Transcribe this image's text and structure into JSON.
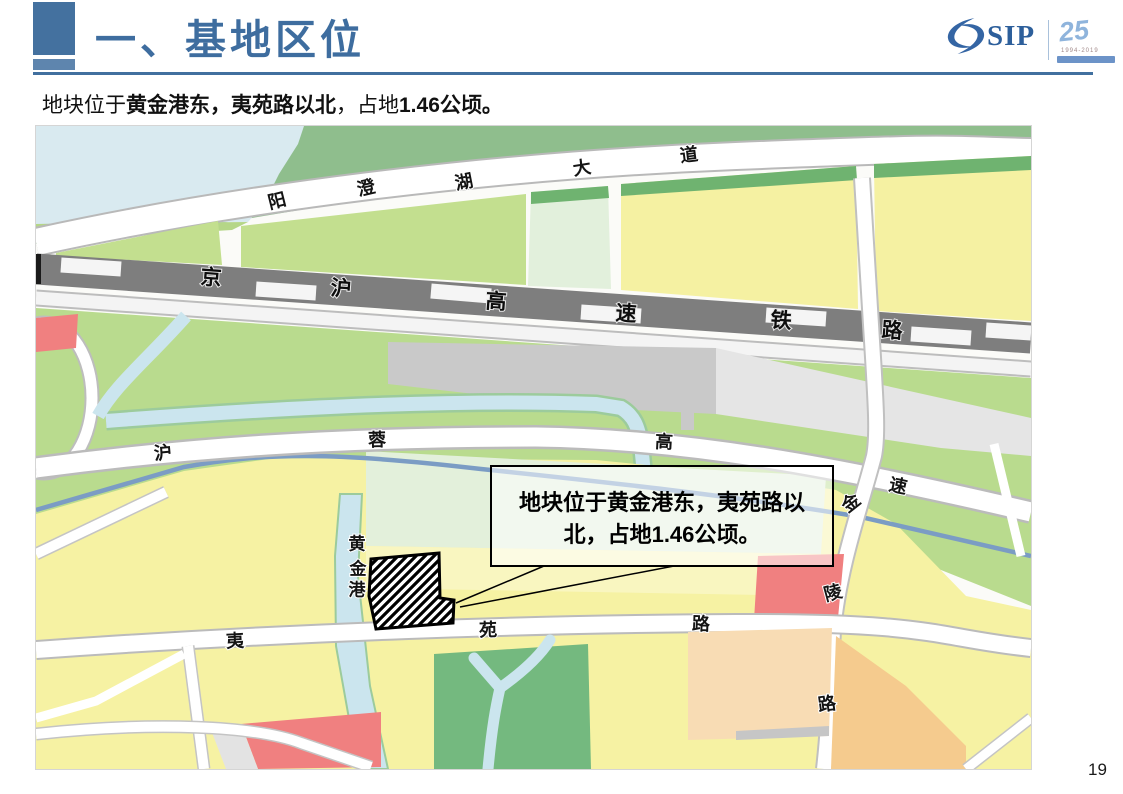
{
  "header": {
    "title": "一、基地区位"
  },
  "subtitle": {
    "pre": "地块位于",
    "bold1": "黄金港东，夷苑路以北",
    "mid": "，占地",
    "bold2": "1.46公顷。"
  },
  "logo": {
    "sip": "SIP",
    "anniversary": "25",
    "years": "1994-2019"
  },
  "map": {
    "labels": {
      "yangchenghu": [
        "阳",
        "澄",
        "湖",
        "大",
        "道"
      ],
      "jinghu": [
        "京",
        "沪",
        "高",
        "速",
        "铁",
        "路"
      ],
      "hurong": [
        "沪",
        "蓉",
        "高",
        "速"
      ],
      "jinling": [
        "金",
        "陵",
        "路"
      ],
      "huangjingang": [
        "黄",
        "金",
        "港"
      ],
      "yiyuan": [
        "夷",
        "苑",
        "路"
      ]
    },
    "callout": {
      "line1": "地块位于黄金港东，夷苑路以",
      "line2": "北，占地1.46公顷。"
    }
  },
  "page_number": "19",
  "colors": {
    "title_blue": "#3E6D9F",
    "water": "#D9EAF0",
    "green_mid": "#8FBE8D",
    "green_band": "#B9DB8E",
    "yellow_parcel": "#F6F2A3",
    "red_parcel": "#F08080",
    "orange_parcel": "#F8DCB4",
    "railway_gray": "#7E7E7E",
    "river_blue": "#7B9CC4",
    "canal_blue": "#CBE5EE"
  }
}
